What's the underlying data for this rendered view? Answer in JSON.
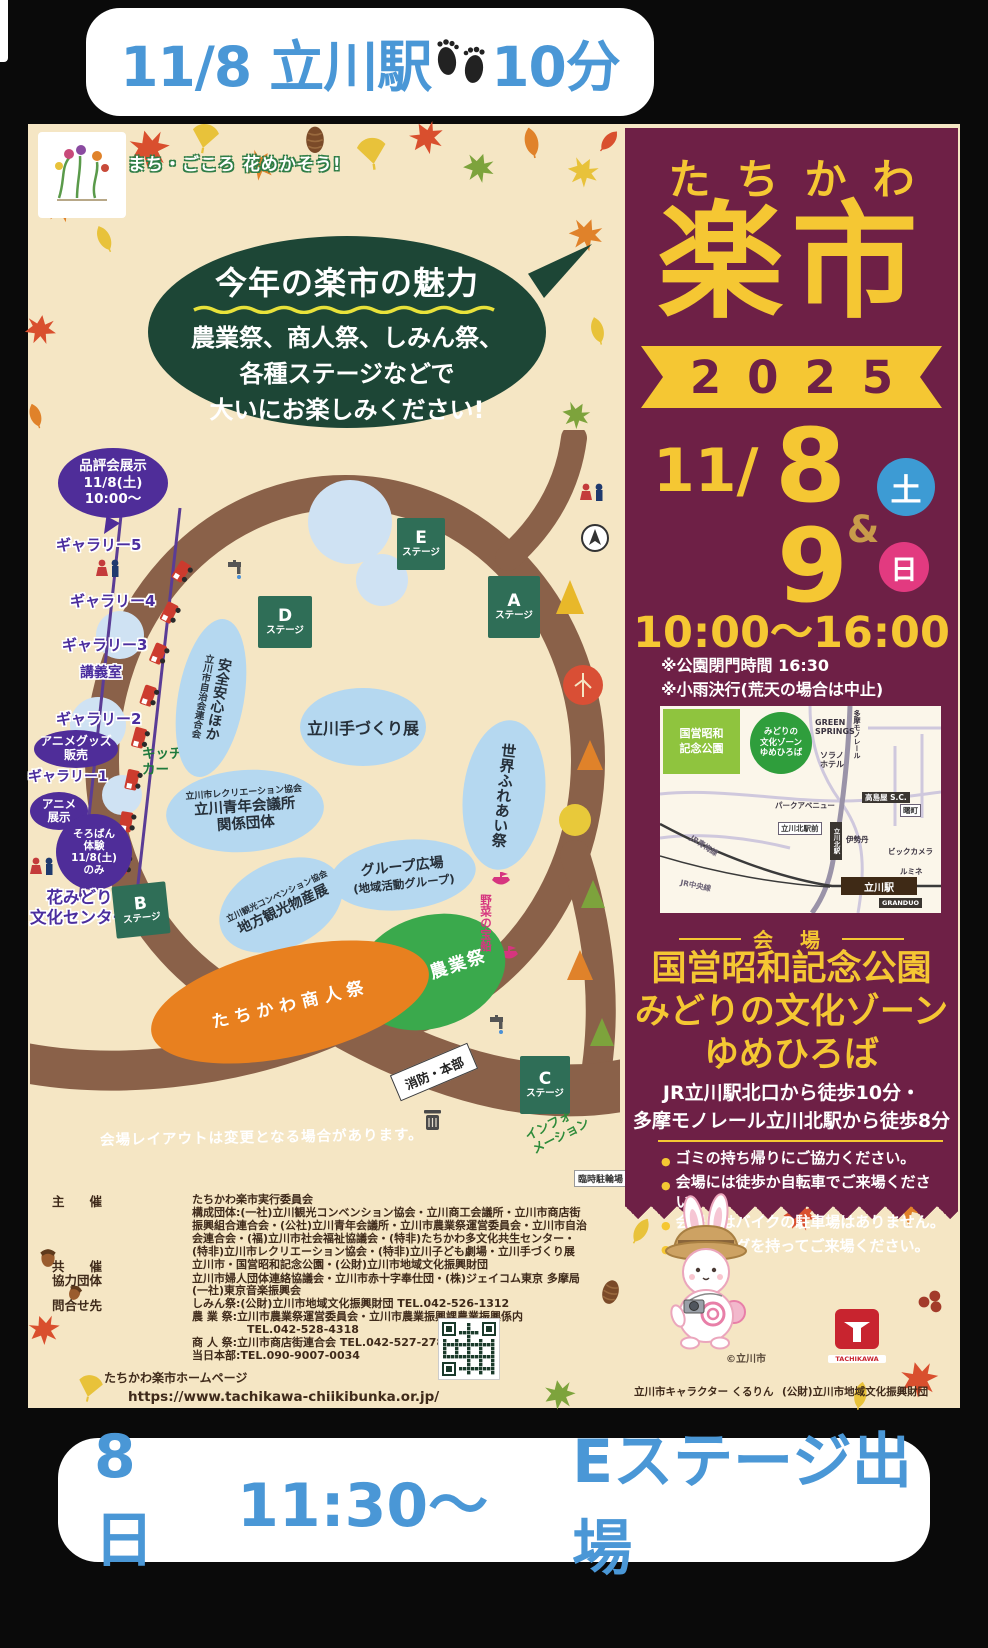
{
  "colors": {
    "accent_blue": "#4a97d6",
    "maroon": "#6e2046",
    "yellow": "#f5c733",
    "saturday_blue": "#3d9bd4",
    "sunday_pink": "#e23a80",
    "bubble_green": "#1d4636",
    "stage_teal": "#2f6e57",
    "gallery_purple": "#4b2e9e"
  },
  "top_banner": {
    "text": "11/8 立川駅",
    "suffix": "10分"
  },
  "bottom_banner": {
    "date": "8日",
    "time": "11:30〜",
    "stage": "Eステージ出場"
  },
  "poster": {
    "slogan": "まち・ごころ 花めかそう!",
    "bubble_title": "今年の楽市の魅力",
    "bubble_body": "農業祭、商人祭、しみん祭、\n各種ステージなどで\n大いにお楽しみください!"
  },
  "map": {
    "exhibit_bubble": "品評会展示\n11/8(土)\n10:00〜",
    "gallery5": "ギャラリー5",
    "gallery4": "ギャラリー4",
    "gallery3": "ギャラリー3",
    "lecture_room": "講義室",
    "gallery2": "ギャラリー2",
    "gallery1": "ギャラリー1",
    "anime_goods": "アニメグッズ\n販売",
    "anime_exhibit": "アニメ\n展示",
    "soroban": "そろばん\n体験\n11/8(土)\nのみ",
    "hanamidori": "花みどり\n文化センター",
    "kitchen_car": "キッチン\nカー",
    "stage_e": "E",
    "stage_a": "A",
    "stage_d": "D",
    "stage_b": "B",
    "stage_c": "C",
    "stage_suffix": "ステージ",
    "jichikai": "安全安心ほか",
    "jichikai_org": "立川市自治会連合会",
    "tezukuri": "立川手づくり展",
    "sekai": "世界ふれあい祭",
    "rec_org": "立川市レクリエーション協会",
    "rec_line1": "立川青年会議所",
    "rec_line2": "関係団体",
    "gp_line1": "グループ広場",
    "gp_line2": "(地域活動グループ)",
    "bussan_org": "立川観光コンベンション協会",
    "bussan_main": "地方観光物産展",
    "nogyosai": "立川市農業祭",
    "akindosai": "たちかわ商人祭",
    "yasai_boat": "野菜の宝船",
    "fire_hq": "消防・本部",
    "information": "インフォ\nメーション",
    "rinji_parking": "臨時駐輪場",
    "disclaimer": "会場レイアウトは変更となる場合があります。"
  },
  "panel": {
    "title_kana": "たちかわ",
    "title_main": "楽市",
    "year": "2025",
    "month": "11/",
    "day1": "8",
    "day1_week": "土",
    "amp": "&",
    "day2": "9",
    "day2_week": "日",
    "time": "10:00〜16:00",
    "note1": "※公園閉門時間 16:30",
    "note2": "※小雨決行(荒天の場合は中止)",
    "venue_label": "会 場",
    "venue": "国営昭和記念公園\nみどりの文化ゾーン\nゆめひろば",
    "access": "JR立川駅北口から徒歩10分・\n多摩モノレール立川北駅から徒歩8分",
    "bullets": [
      "ゴミの持ち帰りにご協力ください。",
      "会場には徒歩か自転車でご来場ください。",
      "会場にはバイクの駐車場はありません。",
      "マイバッグを持ってご来場ください。"
    ],
    "access_map": {
      "park": "国営昭和\n記念公園",
      "zone": "みどりの\n文化ゾーン\nゆめひろば",
      "green_springs": "GREEN\nSPRINGS",
      "sorano": "ソラノ\nホテル",
      "monorail": "多摩モノレール",
      "park_avenue": "パークアベニュー",
      "takashimaya": "高島屋\nS.C.",
      "akebono": "曙町",
      "kita_front": "立川北駅前",
      "kita_sta": "立川北駅",
      "isetan": "伊勢丹",
      "bic": "ビックカメラ",
      "lumine": "ルミネ",
      "ome_line": "JR青梅線",
      "chuo_line": "JR中央線",
      "tachikawa_sta": "立川駅",
      "granduo": "GRANDUO"
    }
  },
  "footer": {
    "host_label": "主　　催",
    "host": "たちかわ楽市実行委員会",
    "host_detail": "構成団体:(一社)立川観光コンベンション協会・立川商工会議所・立川市商店街\n振興組合連合会・(公社)立川青年会議所・立川市農業祭運営委員会・立川市自治\n会連合会・(福)立川市社会福祉協議会・(特非)たちかわ多文化共生センター・\n(特非)立川市レクリエーション協会・(特非)立川子ども劇場・立川手づくり展",
    "cohost_label": "共　　催",
    "cohost": "立川市・国営昭和記念公園・(公財)立川市地域文化振興財団",
    "support_label": "協力団体",
    "support": "立川市婦人団体連絡協議会・立川市赤十字奉仕団・(株)ジェイコム東京 多摩局\n(一社)東京音楽振興会",
    "contact_label": "問合せ先",
    "contact": "しみん祭:(公財)立川市地域文化振興財団 TEL.042-526-1312\n農 業 祭:立川市農業祭運営委員会・立川市農業振興課農業振興係内\n　　　　　TEL.042-528-4318\n商 人 祭:立川市商店街連合会 TEL.042-527-2788\n当日本部:TEL.090-9007-0034",
    "homepage_label": "たちかわ楽市ホームページ",
    "homepage_url": "https://www.tachikawa-chiikibunka.or.jp/"
  },
  "character": {
    "copyright": "©立川市",
    "caption": "立川市キャラクター くるりん",
    "foundation": "(公財)立川市地域文化振興財団",
    "logo_text": "TACHIKAWA"
  }
}
